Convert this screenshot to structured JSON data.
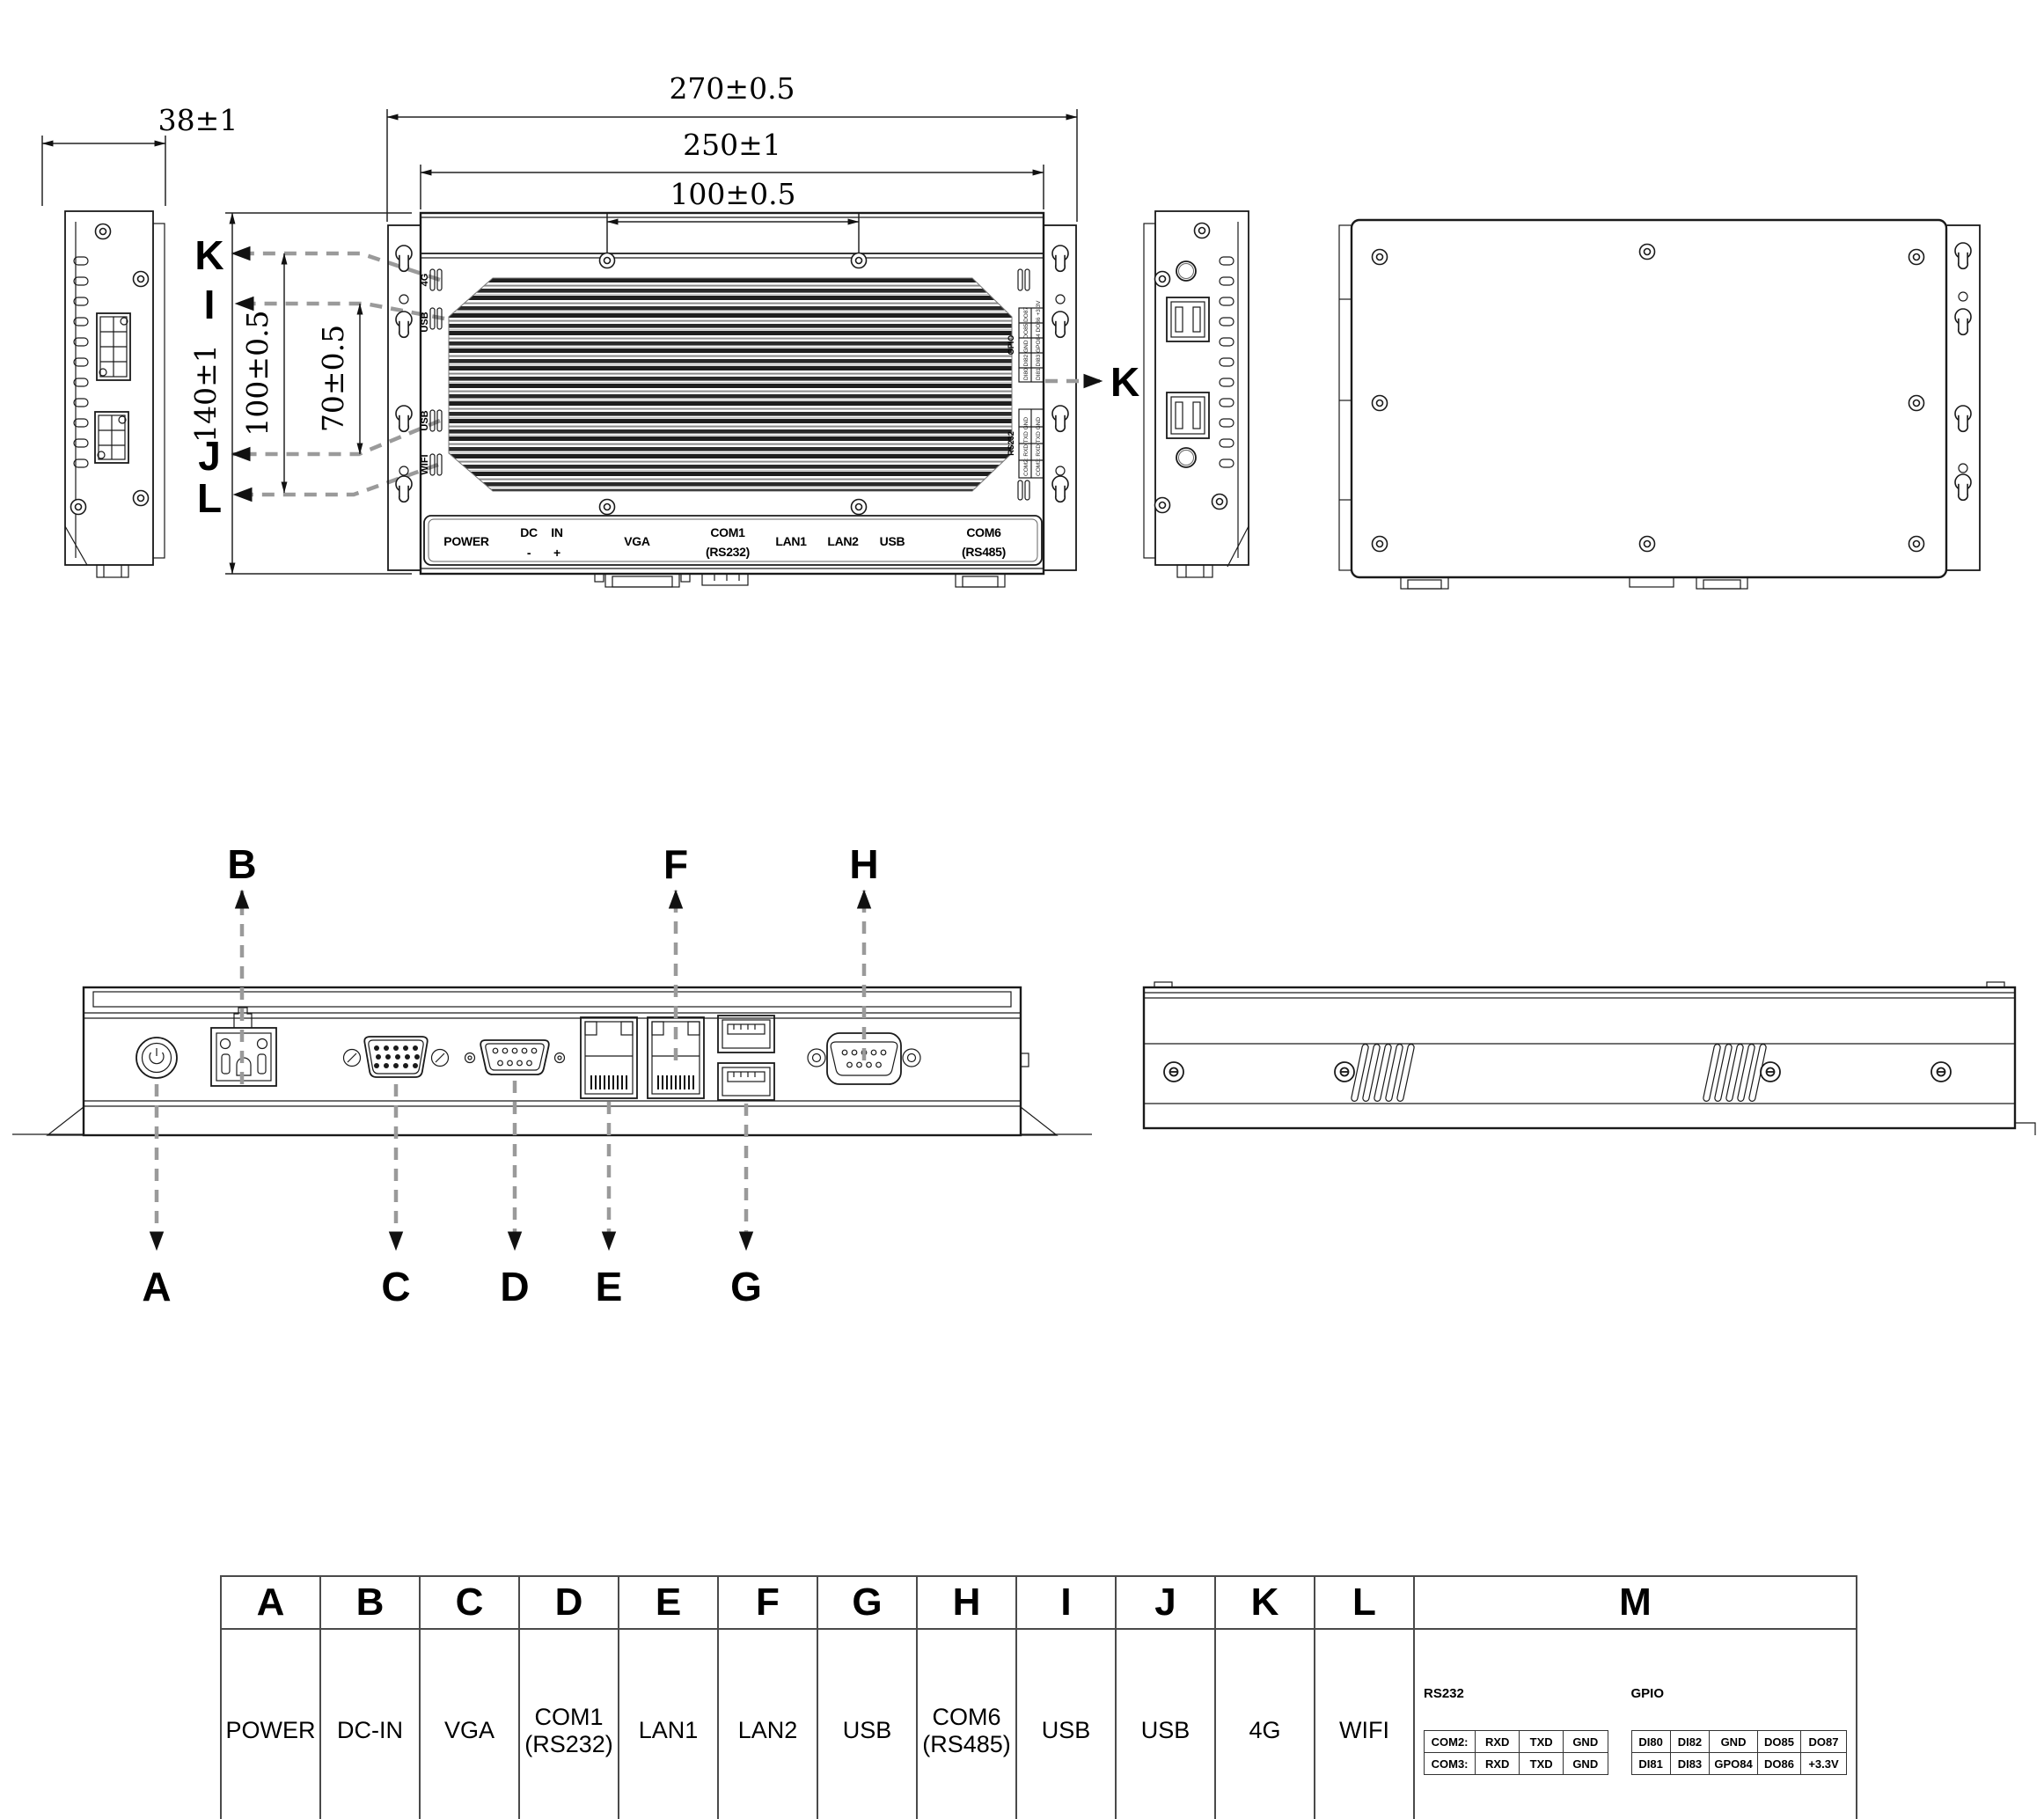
{
  "dimensions": {
    "side_width": "38±1",
    "overall_width": "270±0.5",
    "body_width": "250±1",
    "hole_spacing_top": "100±0.5",
    "body_height": "140±1",
    "hole_spacing_left": "100±0.5",
    "hole_spacing_inner": "70±0.5"
  },
  "top_view": {
    "callouts": {
      "k": "K",
      "i": "I",
      "j": "J",
      "l": "L",
      "k_right": "K"
    },
    "side_labels": [
      "4G",
      "USB",
      "USB",
      "WIFI"
    ],
    "panel_labels": {
      "power": "POWER",
      "dc": "DC",
      "in": "IN",
      "minus": "-",
      "plus": "+",
      "vga": "VGA",
      "com1": "COM1",
      "com1_sub": "(RS232)",
      "lan1": "LAN1",
      "lan2": "LAN2",
      "usb": "USB",
      "com6": "COM6",
      "com6_sub": "(RS485)"
    },
    "mini": {
      "gpio_title": "GPIO",
      "rs232_title": "RS232",
      "gpio_row1": "DI80 DI82 GND DO85 DO87",
      "gpio_row2": "DI81 DI83 GPO84 DO86 +3.3V",
      "rs232_row1": "COM2: RXD TXD GND",
      "rs232_row2": "COM3: RXD TXD GND"
    }
  },
  "front_view": {
    "callouts_top": {
      "b": "B",
      "f": "F",
      "h": "H"
    },
    "callouts_bottom": {
      "a": "A",
      "c": "C",
      "d": "D",
      "e": "E",
      "g": "G"
    }
  },
  "legend": {
    "headers": [
      "A",
      "B",
      "C",
      "D",
      "E",
      "F",
      "G",
      "H",
      "I",
      "J",
      "K",
      "L",
      "M"
    ],
    "labels": [
      "POWER",
      "DC-IN",
      "VGA",
      "COM1\n(RS232)",
      "LAN1",
      "LAN2",
      "USB",
      "COM6\n(RS485)",
      "USB",
      "USB",
      "4G",
      "WIFI"
    ],
    "m": {
      "rs232_title": "RS232",
      "rs232_rows": [
        [
          "COM2:",
          "RXD",
          "TXD",
          "GND"
        ],
        [
          "COM3:",
          "RXD",
          "TXD",
          "GND"
        ]
      ],
      "gpio_title": "GPIO",
      "gpio_rows": [
        [
          "DI80",
          "DI82",
          "GND",
          "DO85",
          "DO87"
        ],
        [
          "DI81",
          "DI83",
          "GPO84",
          "DO86",
          "+3.3V"
        ]
      ]
    }
  }
}
